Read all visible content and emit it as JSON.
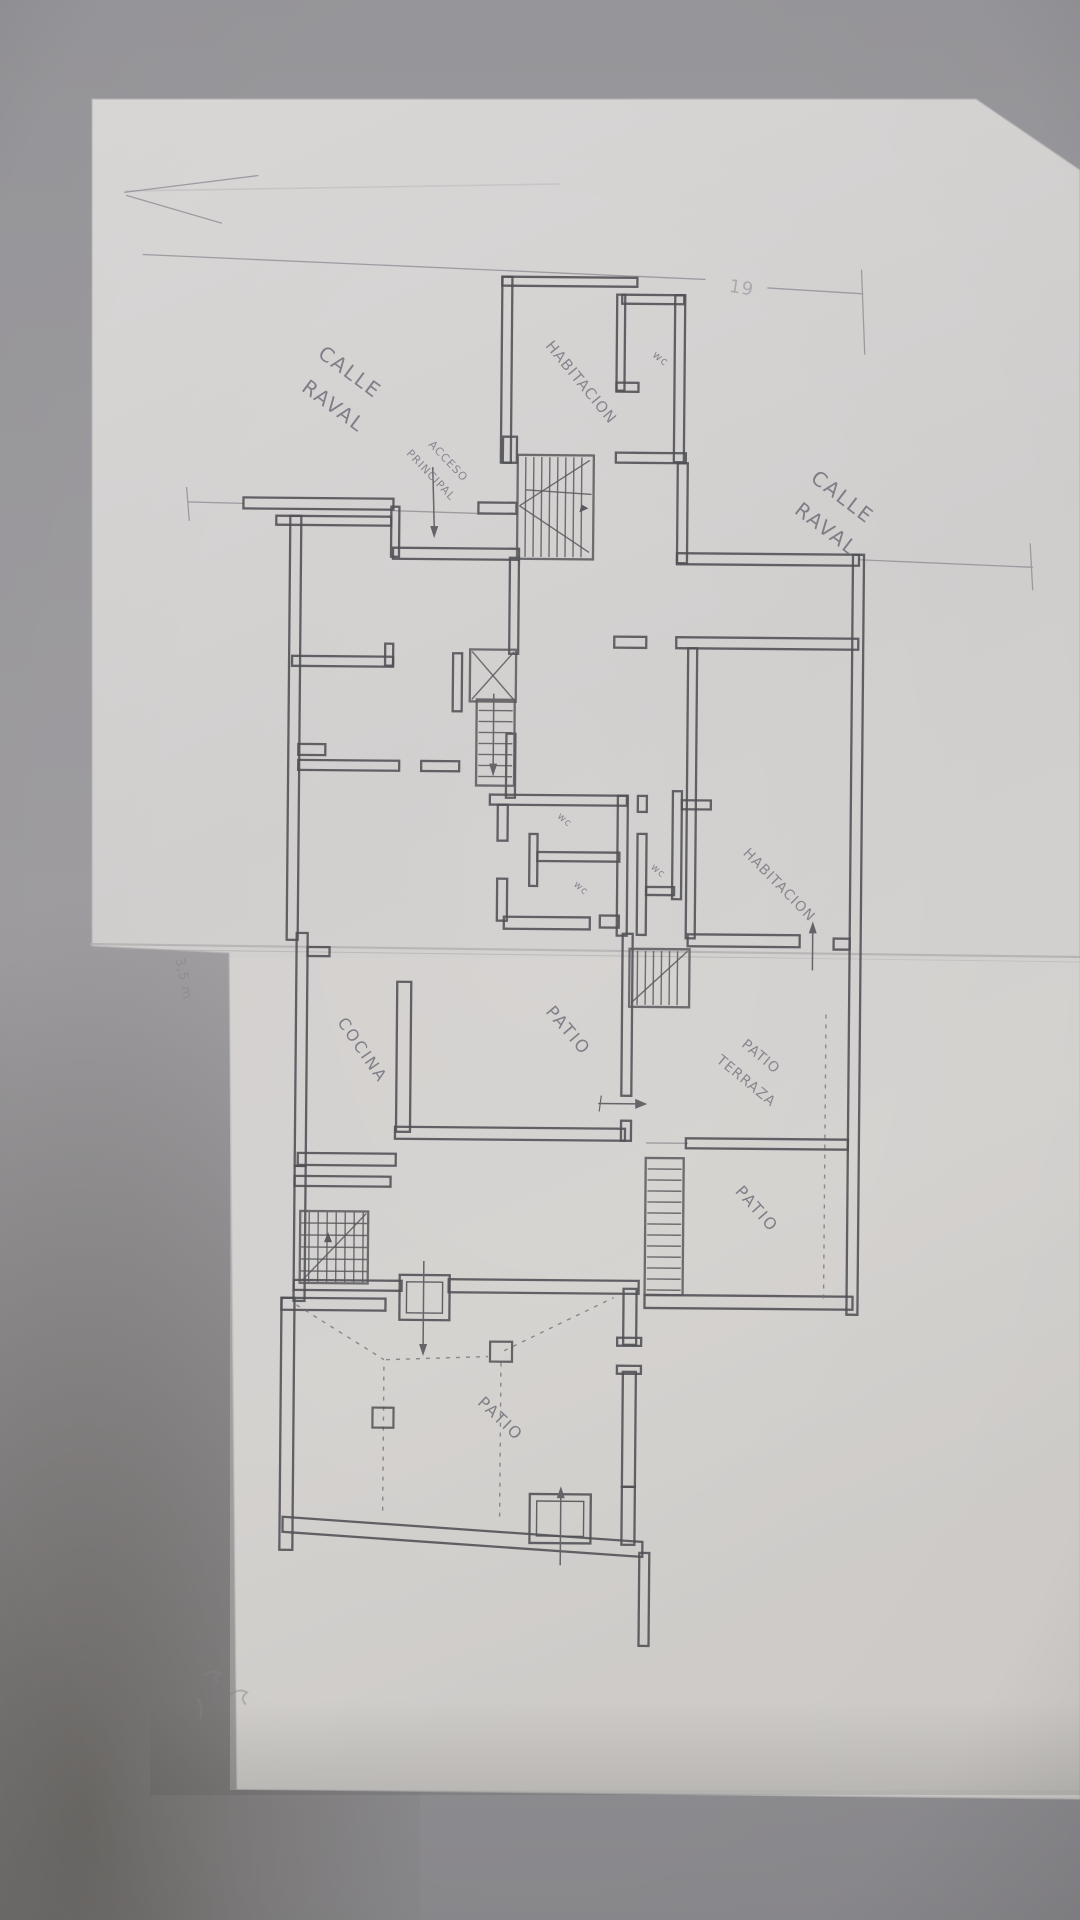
{
  "document": {
    "kind": "hand-drawn pencil floor plan on tracing paper, photographed"
  },
  "colors": {
    "background": "#8f8e92",
    "paper": "#d6d4d3",
    "pencil_wall": "#515055",
    "pencil_faint": "#8d8b92",
    "label_ink": "#6e6d78"
  },
  "labels": {
    "street_top_left_line1": "CALLE",
    "street_top_left_line2": "RAVAL",
    "street_right_line1": "CALLE",
    "street_right_line2": "RAVAL",
    "bedroom_top": "HABITACION",
    "bedroom_mid": "HABITACION",
    "kitchen": "COCINA",
    "patio_center": "PATIO",
    "patio_terrace_line1": "PATIO",
    "patio_terrace_line2": "TERRAZA",
    "patio_right": "PATIO",
    "patio_bottom": "PATIO",
    "wc_top": "wc",
    "wc_mid_a": "wc",
    "wc_mid_b": "wc",
    "wc_mid_c": "wc",
    "entrance_line1": "ACCESO",
    "entrance_line2": "PRINCIPAL",
    "dimension_top_right": "19",
    "dimension_left_margin": "3,5 m"
  }
}
